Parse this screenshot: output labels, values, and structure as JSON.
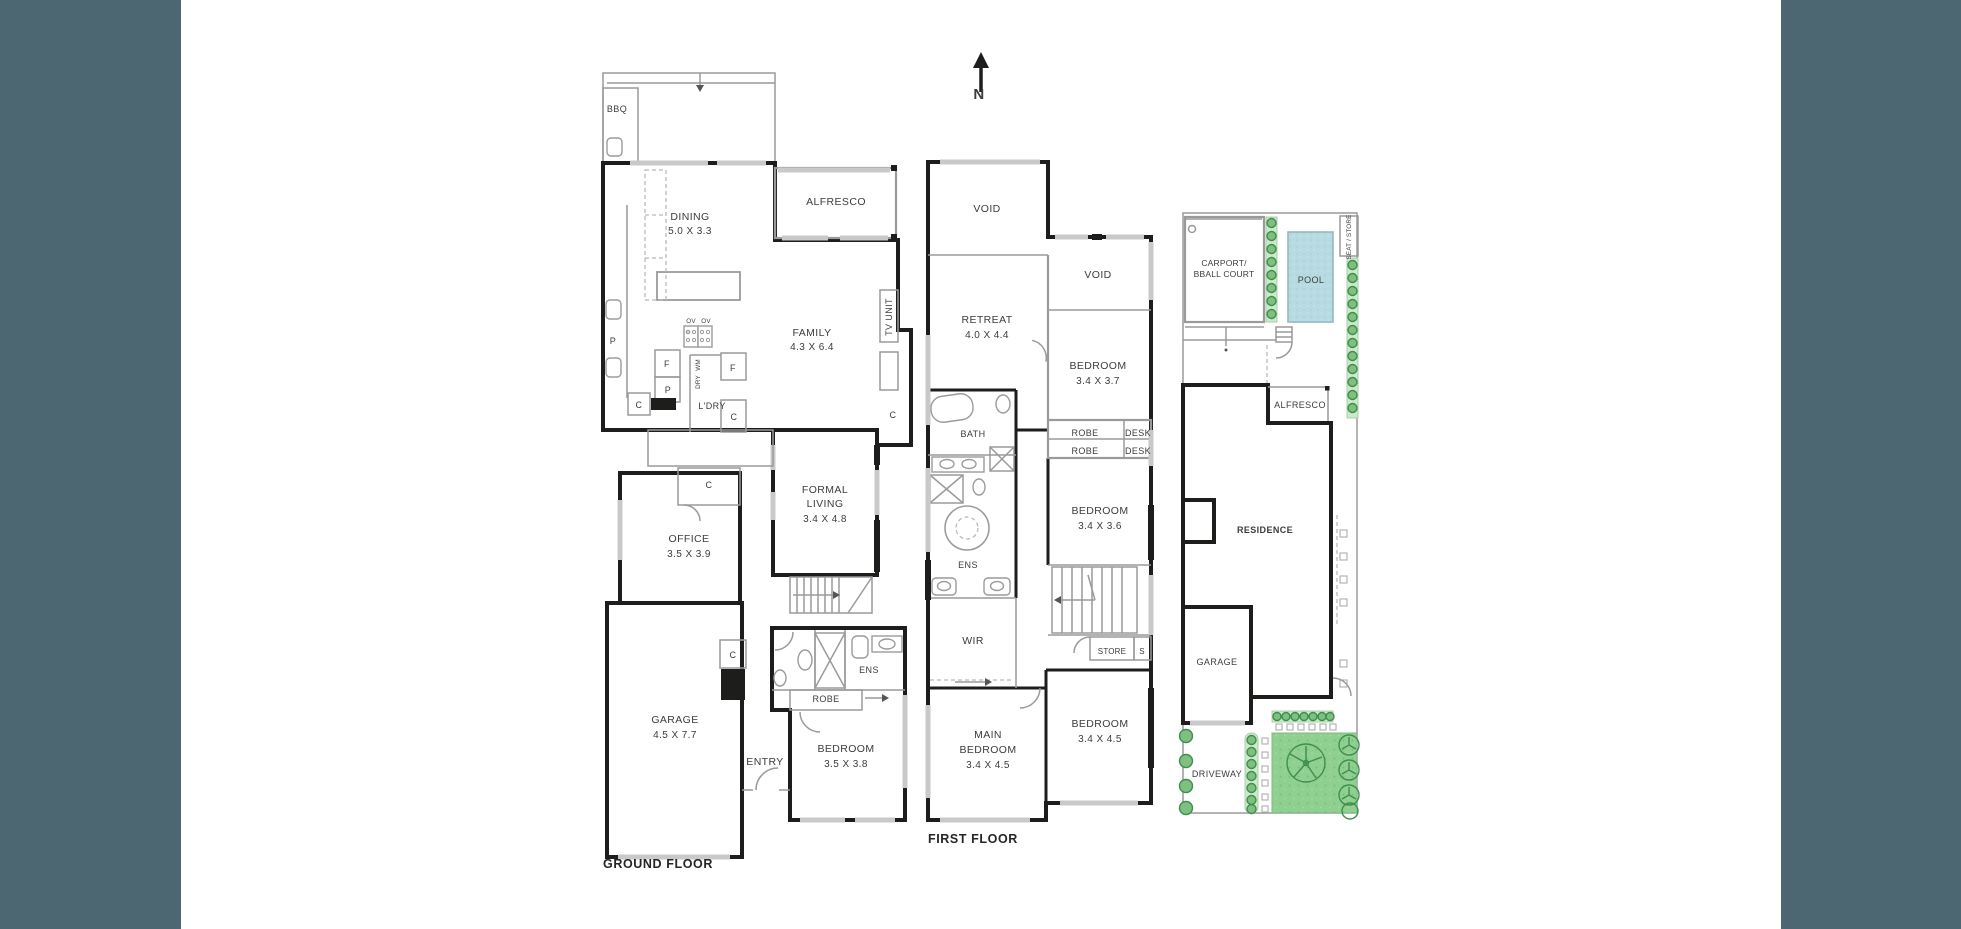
{
  "colors": {
    "sidebar": "#4c6771",
    "wall": "#1d1d1b",
    "window": "#c9c9c9",
    "line": "#9a9a9a",
    "text": "#3c3c3c",
    "pool_fill": "#b8dbe3",
    "lawn_fill": "#8fcf90",
    "hedge": "#cde9cb",
    "tree": "#3e8e4e"
  },
  "compass": {
    "north_label": "N"
  },
  "ground_floor": {
    "title": "GROUND FLOOR",
    "rooms": {
      "bbq": {
        "name": "BBQ"
      },
      "dining": {
        "name": "DINING",
        "dims": "5.0 X 3.3"
      },
      "alfresco": {
        "name": "ALFRESCO"
      },
      "family": {
        "name": "FAMILY",
        "dims": "4.3 X 6.4"
      },
      "tv_unit": {
        "name": "TV UNIT"
      },
      "laundry": {
        "name": "L'DRY"
      },
      "formal_living": {
        "line1": "FORMAL",
        "line2": "LIVING",
        "dims": "3.4 X 4.8"
      },
      "office": {
        "name": "OFFICE",
        "dims": "3.5 X 3.9"
      },
      "garage": {
        "name": "GARAGE",
        "dims": "4.5 X 7.7"
      },
      "entry": {
        "name": "ENTRY"
      },
      "robe": {
        "name": "ROBE"
      },
      "ens": {
        "name": "ENS"
      },
      "bedroom": {
        "name": "BEDROOM",
        "dims": "3.5 X 3.8"
      }
    },
    "markers": {
      "pantry": "P",
      "fridge": "F",
      "cupboard": "C",
      "oven": "OV",
      "washer": "WM",
      "dryer": "DRY"
    }
  },
  "first_floor": {
    "title": "FIRST FLOOR",
    "rooms": {
      "void_left": {
        "name": "VOID"
      },
      "void_right": {
        "name": "VOID"
      },
      "retreat": {
        "name": "RETREAT",
        "dims": "4.0 X 4.4"
      },
      "bedroom2": {
        "name": "BEDROOM",
        "dims": "3.4 X 3.7"
      },
      "bath": {
        "name": "BATH"
      },
      "robe": {
        "name": "ROBE"
      },
      "desk": {
        "name": "DESK"
      },
      "bedroom3": {
        "name": "BEDROOM",
        "dims": "3.4 X 3.6"
      },
      "ens": {
        "name": "ENS"
      },
      "wir": {
        "name": "WIR"
      },
      "store": {
        "name": "STORE"
      },
      "store_s": {
        "name": "S"
      },
      "main_bedroom": {
        "line1": "MAIN",
        "line2": "BEDROOM",
        "dims": "3.4 X 4.5"
      },
      "bedroom4": {
        "name": "BEDROOM",
        "dims": "3.4 X 4.5"
      }
    }
  },
  "site_plan": {
    "labels": {
      "carport": {
        "line1": "CARPORT/",
        "line2": "BBALL COURT"
      },
      "pool": {
        "name": "POOL"
      },
      "seat_store": {
        "name": "SEAT / STORE"
      },
      "alfresco": {
        "name": "ALFRESCO"
      },
      "residence": {
        "name": "RESIDENCE"
      },
      "garage": {
        "name": "GARAGE"
      },
      "driveway": {
        "name": "DRIVEWAY"
      }
    }
  }
}
